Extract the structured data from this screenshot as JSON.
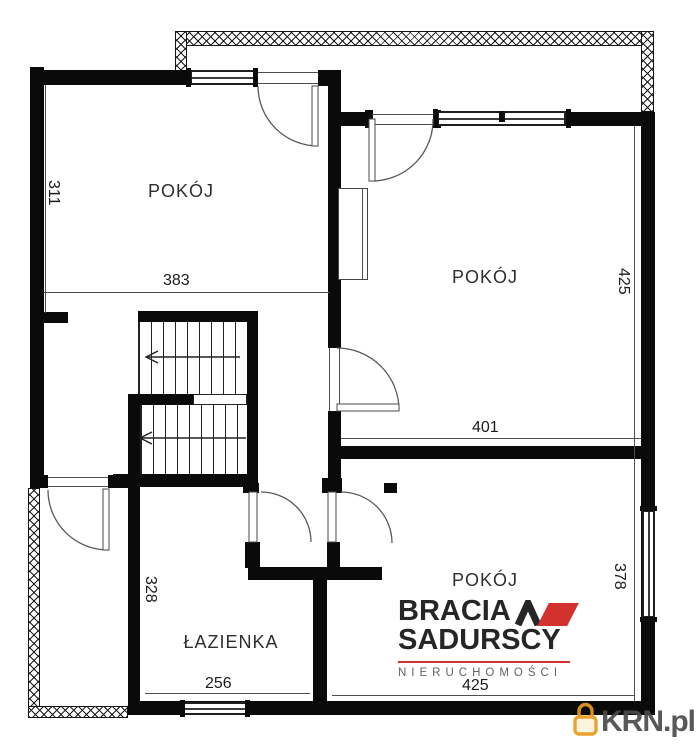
{
  "rooms": {
    "top_left": "POKÓJ",
    "right": "POKÓJ",
    "bottom": "POKÓJ",
    "bathroom": "ŁAZIENKA"
  },
  "dimensions": {
    "d311": "311",
    "d383": "383",
    "d425_right": "425",
    "d401": "401",
    "d328": "328",
    "d256": "256",
    "d378": "378",
    "d425_bottom": "425"
  },
  "logo": {
    "brand_line1": "BRACIA",
    "brand_line2": "SADURSCY",
    "tagline": "NIERUCHOMOŚCI"
  },
  "watermark": {
    "text": "KRN.pl"
  },
  "icons": {
    "logo_mark": "roof-caret-icon",
    "watermark_icon": "padlock-icon"
  },
  "colors": {
    "wall": "#0a0a0a",
    "logo_red": "#d2312e",
    "logo_text": "#262626",
    "tagline_gray": "#636363",
    "watermark_orange": "#e99b1e",
    "watermark_text": "#4a4a4a"
  }
}
